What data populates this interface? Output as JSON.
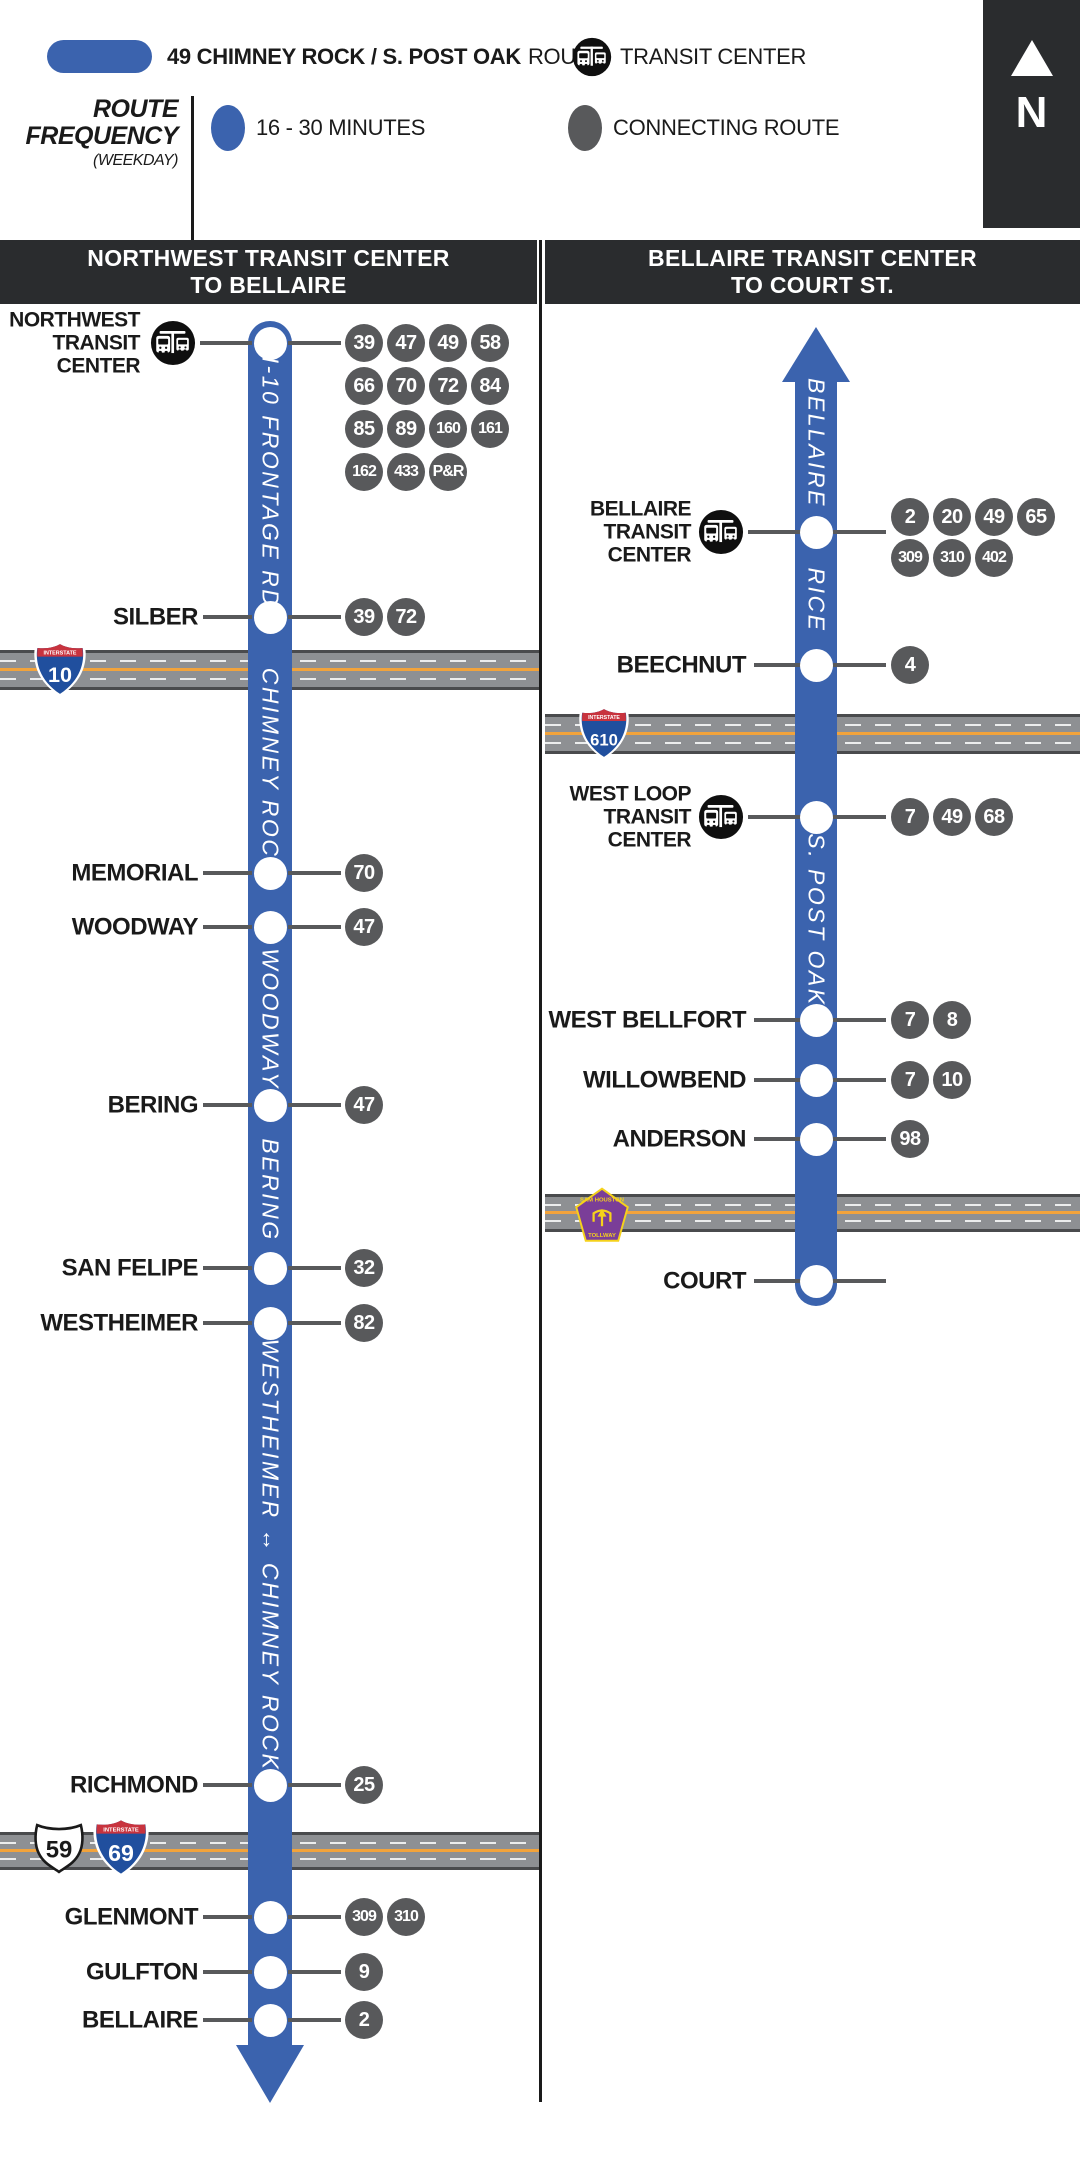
{
  "colors": {
    "route": "#3B63AE",
    "badge": "#58595B",
    "header": "#2A2C2E",
    "road": "#8E9093",
    "road_edge": "#4A4B4D",
    "road_center": "#F2A33B"
  },
  "legend": {
    "route_name": "49 CHIMNEY ROCK / S. POST OAK",
    "route_suffix": "ROUTE",
    "transit_center": "TRANSIT CENTER",
    "freq_line1": "ROUTE",
    "freq_line2": "FREQUENCY",
    "freq_note": "(WEEKDAY)",
    "freq_value": "16 - 30 MINUTES",
    "connecting": "CONNECTING ROUTE"
  },
  "north": {
    "label": "N"
  },
  "divider": {
    "x": 539,
    "w": 3,
    "top": 240,
    "bottom": 2102
  },
  "columns": [
    {
      "id": "northwest-to-bellaire",
      "header": {
        "lines": [
          "NORTHWEST TRANSIT CENTER",
          "TO BELLAIRE"
        ],
        "x": 0,
        "w": 537
      },
      "line": {
        "cx": 270,
        "w": 44,
        "top": 321,
        "shaft_end": 2046,
        "cap": "round-top",
        "arrow": "down",
        "arrow_tip": 2103,
        "arrow_half": 34
      },
      "geom": {
        "label_right": 198,
        "label_right_tc": 140,
        "icon_cx": 173,
        "tick_left": [
          203,
          252
        ],
        "tick_right": [
          288,
          341
        ],
        "badge_x0": 345,
        "badge_d": 38,
        "badge_gap": 4
      },
      "street_labels": [
        {
          "text": "I-10 FRONTAGE RD.",
          "y": 487
        },
        {
          "text": "CHIMNEY ROCK",
          "y": 772
        },
        {
          "text": "WOODWAY",
          "y": 1019
        },
        {
          "text": "BERING",
          "y": 1190
        },
        {
          "text": "WESTHEIMER ↔ CHIMNEY ROCK",
          "y": 1555
        }
      ],
      "highways": [
        {
          "label": "I-10",
          "y": 650,
          "h": 40,
          "x": 0,
          "w": 539,
          "shields": [
            {
              "kind": "interstate",
              "num": "10",
              "x": 33,
              "y": 640,
              "w": 54,
              "h": 58
            }
          ]
        },
        {
          "label": "US-59 / I-69",
          "y": 1832,
          "h": 38,
          "x": 0,
          "w": 539,
          "shields": [
            {
              "kind": "us",
              "num": "59",
              "x": 33,
              "y": 1820,
              "w": 52,
              "h": 56
            },
            {
              "kind": "interstate",
              "num": "69",
              "x": 92,
              "y": 1816,
              "w": 58,
              "h": 62
            }
          ]
        }
      ],
      "stops": [
        {
          "label": [
            "NORTHWEST",
            "TRANSIT",
            "CENTER"
          ],
          "y": 343,
          "tc": true,
          "routes": [
            {
              "y": 343,
              "items": [
                "39",
                "47",
                "49",
                "58"
              ]
            },
            {
              "y": 386,
              "items": [
                "66",
                "70",
                "72",
                "84"
              ]
            },
            {
              "y": 429,
              "items": [
                "85",
                "89",
                "160",
                "161"
              ]
            },
            {
              "y": 472,
              "items": [
                "162",
                "433",
                "P&R"
              ]
            }
          ]
        },
        {
          "label": "SILBER",
          "y": 617,
          "routes": [
            {
              "y": 617,
              "items": [
                "39",
                "72"
              ]
            }
          ]
        },
        {
          "label": "MEMORIAL",
          "y": 873,
          "routes": [
            {
              "y": 873,
              "items": [
                "70"
              ]
            }
          ]
        },
        {
          "label": "WOODWAY",
          "y": 927,
          "routes": [
            {
              "y": 927,
              "items": [
                "47"
              ]
            }
          ]
        },
        {
          "label": "BERING",
          "y": 1105,
          "routes": [
            {
              "y": 1105,
              "items": [
                "47"
              ]
            }
          ]
        },
        {
          "label": "SAN FELIPE",
          "y": 1268,
          "routes": [
            {
              "y": 1268,
              "items": [
                "32"
              ]
            }
          ]
        },
        {
          "label": "WESTHEIMER",
          "y": 1323,
          "routes": [
            {
              "y": 1323,
              "items": [
                "82"
              ]
            }
          ]
        },
        {
          "label": "RICHMOND",
          "y": 1785,
          "routes": [
            {
              "y": 1785,
              "items": [
                "25"
              ]
            }
          ]
        },
        {
          "label": "GLENMONT",
          "y": 1917,
          "routes": [
            {
              "y": 1917,
              "items": [
                "309",
                "310"
              ]
            }
          ]
        },
        {
          "label": "GULFTON",
          "y": 1972,
          "routes": [
            {
              "y": 1972,
              "items": [
                "9"
              ]
            }
          ]
        },
        {
          "label": "BELLAIRE",
          "y": 2020,
          "routes": [
            {
              "y": 2020,
              "items": [
                "2"
              ]
            }
          ]
        }
      ]
    },
    {
      "id": "bellaire-to-court",
      "header": {
        "lines": [
          "BELLAIRE TRANSIT CENTER",
          "TO COURT ST."
        ],
        "x": 545,
        "w": 535
      },
      "line": {
        "cx": 816,
        "w": 42,
        "top": 380,
        "shaft_end": 1306,
        "cap": "round-bottom",
        "arrow": "up",
        "arrow_tip": 327,
        "arrow_half": 34
      },
      "geom": {
        "label_right": 746,
        "label_right_tc": 691,
        "icon_cx": 721,
        "tick_left": [
          754,
          801
        ],
        "tick_right": [
          833,
          886
        ],
        "badge_x0": 891,
        "badge_d": 38,
        "badge_gap": 4
      },
      "street_labels": [
        {
          "text": "BELLAIRE",
          "y": 443
        },
        {
          "text": "RICE",
          "y": 600
        },
        {
          "text": "S. POST OAK",
          "y": 920
        }
      ],
      "highways": [
        {
          "label": "I-610",
          "y": 714,
          "h": 40,
          "x": 545,
          "w": 535,
          "shields": [
            {
              "kind": "interstate",
              "num": "610",
              "x": 578,
              "y": 704,
              "w": 52,
              "h": 58
            }
          ]
        },
        {
          "label": "SAM HOUSTON TOLLWAY",
          "y": 1194,
          "h": 38,
          "x": 545,
          "w": 535,
          "shields": [
            {
              "kind": "tollway",
              "num": "",
              "x": 574,
              "y": 1186,
              "w": 56,
              "h": 58
            }
          ]
        }
      ],
      "stops": [
        {
          "label": [
            "BELLAIRE",
            "TRANSIT",
            "CENTER"
          ],
          "y": 532,
          "tc": true,
          "routes": [
            {
              "y": 517,
              "items": [
                "2",
                "20",
                "49",
                "65"
              ]
            },
            {
              "y": 558,
              "items": [
                "309",
                "310",
                "402"
              ]
            }
          ]
        },
        {
          "label": "BEECHNUT",
          "y": 665,
          "routes": [
            {
              "y": 665,
              "items": [
                "4"
              ]
            }
          ]
        },
        {
          "label": [
            "WEST LOOP",
            "TRANSIT",
            "CENTER"
          ],
          "y": 817,
          "tc": true,
          "routes": [
            {
              "y": 817,
              "items": [
                "7",
                "49",
                "68"
              ]
            }
          ]
        },
        {
          "label": "WEST BELLFORT",
          "y": 1020,
          "routes": [
            {
              "y": 1020,
              "items": [
                "7",
                "8"
              ]
            }
          ]
        },
        {
          "label": "WILLOWBEND",
          "y": 1080,
          "routes": [
            {
              "y": 1080,
              "items": [
                "7",
                "10"
              ]
            }
          ]
        },
        {
          "label": "ANDERSON",
          "y": 1139,
          "routes": [
            {
              "y": 1139,
              "items": [
                "98"
              ]
            }
          ]
        },
        {
          "label": "COURT",
          "y": 1281,
          "routes": []
        }
      ]
    }
  ]
}
